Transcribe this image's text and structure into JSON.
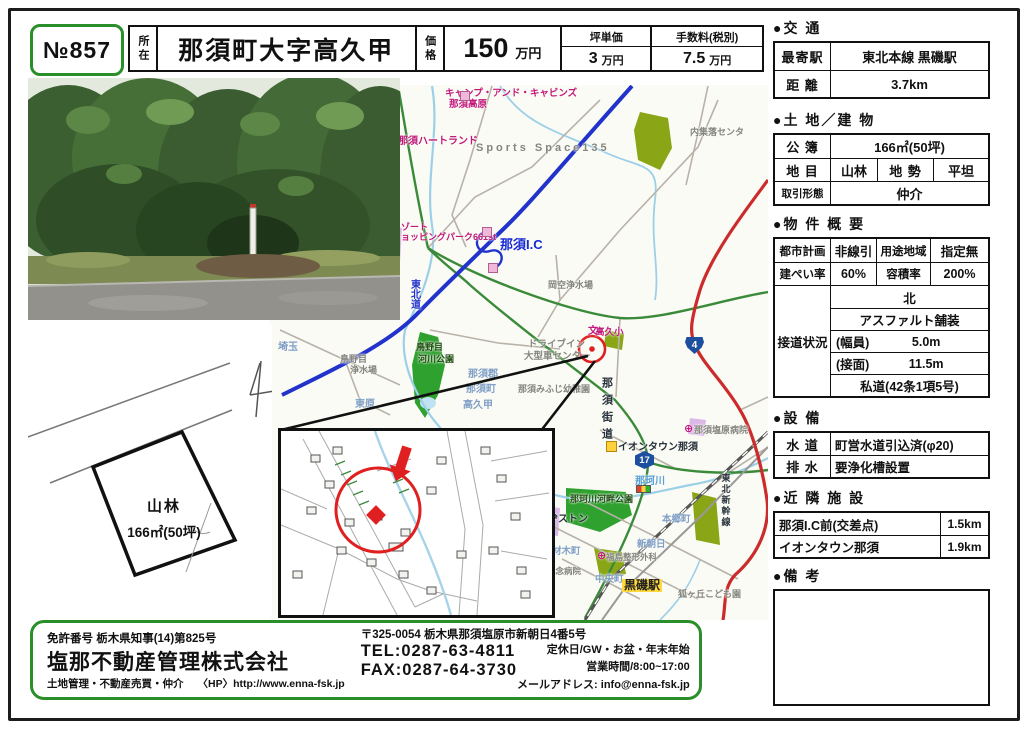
{
  "doc_no": "№857",
  "header": {
    "location_label": "所在",
    "location_value": "那須町大字高久甲",
    "price_label": "価格",
    "price_value": "150",
    "price_unit": "万円",
    "unit_price_label": "坪単価",
    "unit_price_value": "3",
    "unit_price_unit": "万円",
    "fee_label": "手数料(税別)",
    "fee_value": "7.5",
    "fee_unit": "万円"
  },
  "right_panel": {
    "transport": {
      "title": "●交 通",
      "rows": [
        {
          "label": "最寄駅",
          "value": "東北本線 黒磯駅"
        },
        {
          "label": "距 離",
          "value": "3.7km"
        }
      ]
    },
    "land": {
      "title": "●土 地／建 物",
      "koubo_label": "公 簿",
      "koubo_value": "166㎡(50坪)",
      "chimoku_label": "地 目",
      "chimoku_value": "山林",
      "chisei_label": "地 勢",
      "chisei_value": "平坦",
      "torihiki_label": "取引形態",
      "torihiki_value": "仲介"
    },
    "overview": {
      "title": "●物 件 概 要",
      "toshi_label": "都市計画",
      "toshi_value": "非線引",
      "youto_label": "用途地域",
      "youto_value": "指定無",
      "kenpei_label": "建ぺい率",
      "kenpei_value": "60%",
      "youseki_label": "容積率",
      "youseki_value": "200%",
      "setsudou_label": "接道状況",
      "setsudou_rows": [
        "北",
        "アスファルト舗装"
      ],
      "width_label": "(幅員)",
      "width_value": "5.0m",
      "frontage_label": "(接面)",
      "frontage_value": "11.5m",
      "road_type": "私道(42条1項5号)"
    },
    "equipment": {
      "title": "●設 備",
      "rows": [
        {
          "label": "水 道",
          "value": "町営水道引込済(φ20)"
        },
        {
          "label": "排 水",
          "value": "要浄化槽設置"
        }
      ]
    },
    "nearby": {
      "title": "●近 隣 施 設",
      "rows": [
        {
          "label": "那須I.C前(交差点)",
          "value": "1.5km"
        },
        {
          "label": "イオンタウン那須",
          "value": "1.9km"
        }
      ]
    },
    "remarks": {
      "title": "●備 考"
    }
  },
  "sketch": {
    "land_type": "山林",
    "area": "166㎡(50坪)"
  },
  "map": {
    "labels": [
      {
        "text": "キャンプ・アンド・キャビンズ",
        "x": 175,
        "y": 4,
        "cls": "pink",
        "fs": 9.5
      },
      {
        "text": "那須高原",
        "x": 179,
        "y": 15,
        "cls": "pink",
        "fs": 9.5
      },
      {
        "text": "那須ハートランド",
        "x": 128,
        "y": 52,
        "cls": "pink",
        "fs": 10
      },
      {
        "text": "Sports Space135",
        "x": 206,
        "y": 58,
        "cls": "gray",
        "fs": 11,
        "ls": 3
      },
      {
        "text": "リゾート",
        "x": 122,
        "y": 138,
        "cls": "pink",
        "fs": 9
      },
      {
        "text": "ショッピングパーク661st",
        "x": 122,
        "y": 148,
        "cls": "pink",
        "fs": 9
      },
      {
        "text": "那須I.C",
        "x": 230,
        "y": 153,
        "cls": "icblue",
        "fs": 13
      },
      {
        "text": "東北道",
        "x": 138,
        "y": 194,
        "cls": "roadblue",
        "fs": 10,
        "vertical": true
      },
      {
        "text": "内集落センタ",
        "x": 420,
        "y": 43,
        "cls": "gray",
        "fs": 9
      },
      {
        "text": "岡空浄水場",
        "x": 278,
        "y": 196,
        "cls": "gray",
        "fs": 9
      },
      {
        "text": "ドライブイン",
        "x": 258,
        "y": 255,
        "cls": "gray",
        "fs": 9.5
      },
      {
        "text": "大型車センター",
        "x": 254,
        "y": 267,
        "cls": "gray",
        "fs": 9.5
      },
      {
        "text": "高久小",
        "x": 325,
        "y": 243,
        "cls": "pink",
        "fs": 9.5
      },
      {
        "text": "鳥野目",
        "x": 70,
        "y": 270,
        "cls": "gray",
        "fs": 9
      },
      {
        "text": "浄水場",
        "x": 80,
        "y": 281,
        "cls": "gray",
        "fs": 9
      },
      {
        "text": "鳥野目",
        "x": 146,
        "y": 258,
        "cls": "park",
        "fs": 9
      },
      {
        "text": "河川公園",
        "x": 148,
        "y": 270,
        "cls": "park",
        "fs": 9
      },
      {
        "text": "那珂川河畔公園",
        "x": 300,
        "y": 410,
        "cls": "park",
        "fs": 9
      },
      {
        "text": "那須みふじ幼稚園",
        "x": 248,
        "y": 300,
        "cls": "gray",
        "fs": 9
      },
      {
        "text": "那須塩原病院",
        "x": 424,
        "y": 341,
        "cls": "gray",
        "fs": 9
      },
      {
        "text": "福島整形外科",
        "x": 336,
        "y": 468,
        "cls": "gray",
        "fs": 8.5
      },
      {
        "text": "菅間記念病院",
        "x": 260,
        "y": 482,
        "cls": "gray",
        "fs": 8.5
      },
      {
        "text": "狐ヶ丘こども園",
        "x": 408,
        "y": 505,
        "cls": "gray",
        "fs": 9
      },
      {
        "text": "イオンタウン那須",
        "x": 348,
        "y": 358,
        "cls": "dark",
        "fs": 10
      },
      {
        "text": "ブリヂストン",
        "x": 258,
        "y": 430,
        "cls": "dark",
        "fs": 10
      },
      {
        "text": "那須街道",
        "x": 330,
        "y": 292,
        "cls": "dark",
        "fs": 11,
        "vertical": true,
        "ls": 6
      },
      {
        "text": "東北新幹線",
        "x": 450,
        "y": 388,
        "cls": "dark",
        "fs": 9,
        "vertical": true,
        "ls": 2
      },
      {
        "text": "埼玉",
        "x": 8,
        "y": 258,
        "cls": "place",
        "fs": 10
      },
      {
        "text": "東原",
        "x": 85,
        "y": 315,
        "cls": "place",
        "fs": 10
      },
      {
        "text": "那須郡",
        "x": 198,
        "y": 285,
        "cls": "place",
        "fs": 10
      },
      {
        "text": "那須町",
        "x": 196,
        "y": 300,
        "cls": "place",
        "fs": 10
      },
      {
        "text": "高久甲",
        "x": 193,
        "y": 316,
        "cls": "place",
        "fs": 10
      },
      {
        "text": "本郷町",
        "x": 392,
        "y": 430,
        "cls": "place",
        "fs": 9.5
      },
      {
        "text": "新朝日",
        "x": 367,
        "y": 455,
        "cls": "place",
        "fs": 9.5
      },
      {
        "text": "中央町",
        "x": 325,
        "y": 490,
        "cls": "place",
        "fs": 9.5
      },
      {
        "text": "材木町",
        "x": 282,
        "y": 462,
        "cls": "place",
        "fs": 9.5
      },
      {
        "text": "那珂川",
        "x": 365,
        "y": 392,
        "cls": "riverb",
        "fs": 10
      },
      {
        "text": "黒磯駅",
        "x": 352,
        "y": 494,
        "cls": "station",
        "fs": 12
      }
    ],
    "markers": [
      {
        "type": "shield4",
        "x": 415,
        "y": 252,
        "text": "4"
      },
      {
        "type": "shield17",
        "x": 365,
        "y": 366,
        "text": "17"
      },
      {
        "type": "signal",
        "x": 366,
        "y": 400
      },
      {
        "type": "store",
        "x": 336,
        "y": 356
      },
      {
        "type": "hospital",
        "x": 414,
        "y": 339,
        "text": "⊕"
      },
      {
        "type": "hospital",
        "x": 327,
        "y": 466,
        "text": "⊕"
      },
      {
        "type": "hospital",
        "x": 252,
        "y": 480,
        "text": "⊕"
      },
      {
        "type": "school",
        "x": 318,
        "y": 242,
        "text": "文"
      },
      {
        "type": "poi",
        "x": 212,
        "y": 142
      },
      {
        "type": "poi",
        "x": 218,
        "y": 178
      },
      {
        "type": "poi",
        "x": 190,
        "y": 6
      }
    ]
  },
  "footer": {
    "license": "免許番号  栃木県知事(14)第825号",
    "company": "塩那不動産管理株式会社",
    "services": "土地管理・不動産売買・仲介",
    "hp": "〈HP〉http://www.enna-fsk.jp",
    "address": "〒325-0054  栃木県那須塩原市新朝日4番5号",
    "tel": "TEL:0287-63-4811",
    "fax": "FAX:0287-64-3730",
    "holiday": "定休日/GW・お盆・年末年始",
    "hours": "営業時間/8:00~17:00",
    "email": "メールアドレス:  info@enna-fsk.jp"
  },
  "colors": {
    "frame_green": "#2a8f2a",
    "expressway_blue": "#2233cc",
    "national_route_red": "#cc2b2b",
    "local_road_green": "#3a8a3a",
    "river_blue": "#9cd0e8",
    "marker_red": "#e02020",
    "station_yellow": "#ffd93d",
    "route_shield_blue": "#1d4f9e"
  }
}
